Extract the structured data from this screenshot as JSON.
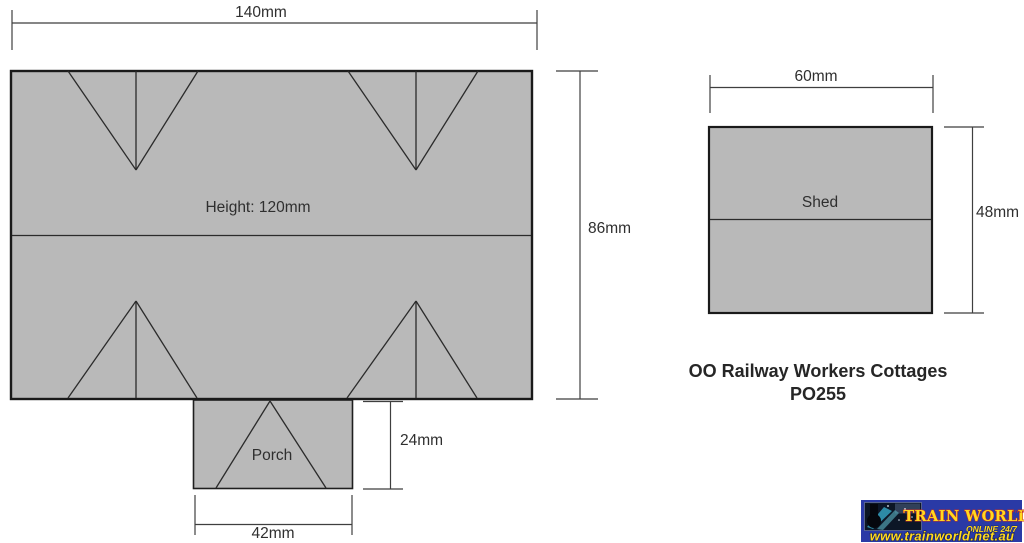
{
  "diagram": {
    "main_building": {
      "interior_label": "Height: 120mm",
      "width_label": "140mm",
      "depth_label": "86mm"
    },
    "porch": {
      "label": "Porch",
      "width_label": "42mm",
      "depth_label": "24mm"
    },
    "shed": {
      "label": "Shed",
      "width_label": "60mm",
      "depth_label": "48mm"
    },
    "caption": {
      "line1": "OO Railway Workers Cottages",
      "line2": "PO255"
    }
  },
  "watermark": {
    "brand": "TRAIN WORLD",
    "brand_suffix": "PTY LTD",
    "tagline": "ONLINE 24/7",
    "url": "www.trainworld.net.au"
  },
  "colors": {
    "footprint_fill": "#b9b9b9",
    "outline": "#1a1a1a",
    "dimension": "#3f3f3f",
    "label_text": "#2f2f2f",
    "banner_blue": "#2a3aa6",
    "banner_yellow": "#ffd91f",
    "banner_red": "#c43026",
    "banner_outline_navy": "#162058",
    "photo_navy": "#0c1626",
    "photo_teal": "#2d8ba6"
  }
}
